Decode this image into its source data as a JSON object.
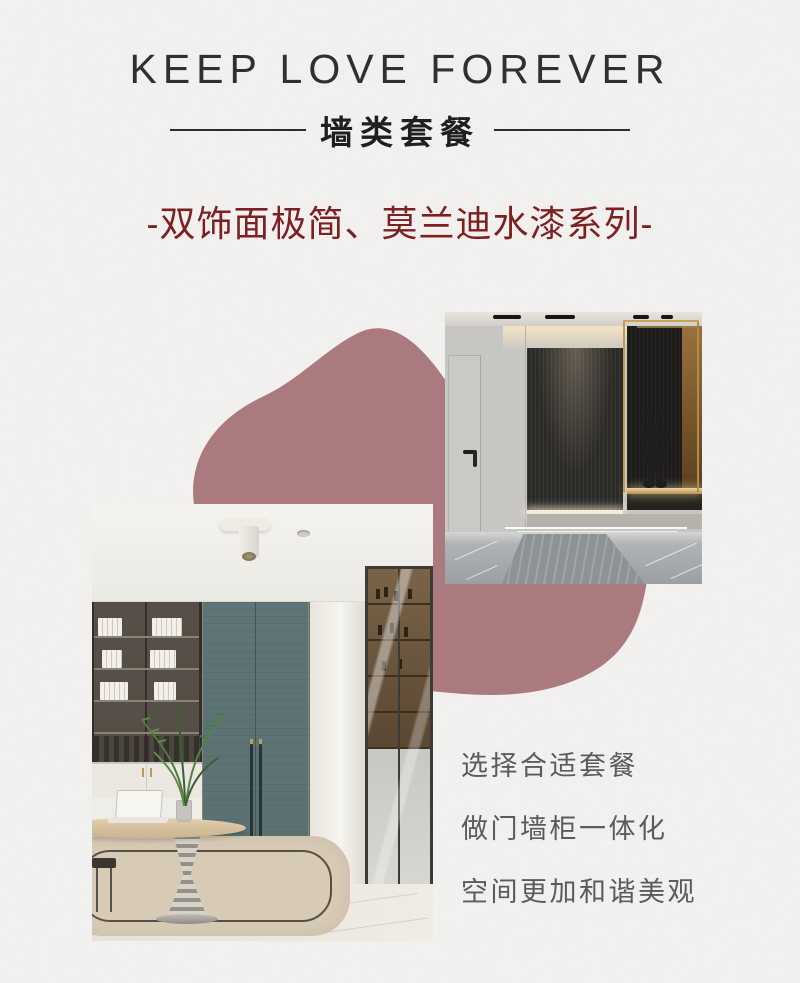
{
  "header": {
    "title": "KEEP LOVE FOREVER",
    "subtitle": "墙类套餐",
    "series_line": "-双饰面极简、莫兰迪水漆系列-"
  },
  "features": {
    "items": [
      {
        "label": "选择合适套餐"
      },
      {
        "label": "做门墙柜一体化"
      },
      {
        "label": "空间更加和谐美观"
      }
    ]
  },
  "photos": {
    "entry": {
      "alt": "玄关门墙柜效果图"
    },
    "study": {
      "alt": "书房门墙柜效果图"
    }
  },
  "colors": {
    "background": "#f5f4f2",
    "title": "#303030",
    "rule": "#2b2b2b",
    "series_red": "#7c2022",
    "blob": "#ab7a7f",
    "feature_text": "#5b5b5b",
    "door_teal": "#5a7072",
    "panel_dark": "#2d2b28",
    "brass": "#c19a58"
  }
}
